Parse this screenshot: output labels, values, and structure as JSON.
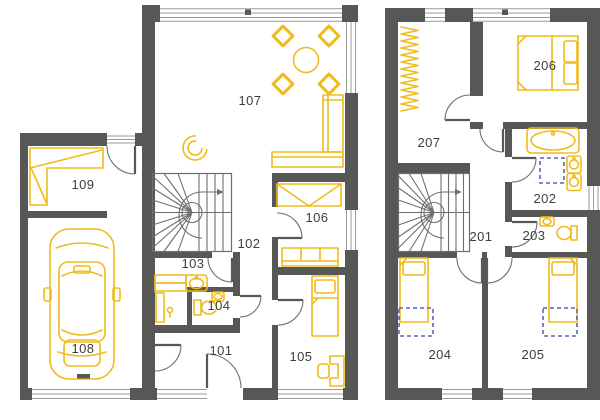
{
  "plan": {
    "type": "architectural-floor-plan",
    "floors": [
      {
        "id": "ground-floor",
        "rooms": [
          {
            "label": "101",
            "features": []
          },
          {
            "label": "102",
            "features": [
              "staircase"
            ]
          },
          {
            "label": "103",
            "features": [
              "washbasin",
              "counter",
              "tap"
            ]
          },
          {
            "label": "104",
            "features": [
              "toilet",
              "washbasin"
            ]
          },
          {
            "label": "105",
            "features": [
              "single-bed",
              "desk",
              "chair"
            ]
          },
          {
            "label": "106",
            "features": [
              "wardrobe",
              "sofa"
            ]
          },
          {
            "label": "107",
            "features": [
              "dining-table",
              "four-chairs",
              "armchair",
              "corner-sofa"
            ]
          },
          {
            "label": "108",
            "features": [
              "car",
              "garage-door"
            ]
          },
          {
            "label": "109",
            "features": [
              "corner-desk"
            ]
          }
        ]
      },
      {
        "id": "upper-floor",
        "rooms": [
          {
            "label": "201",
            "features": [
              "staircase"
            ]
          },
          {
            "label": "202",
            "features": [
              "bathtub",
              "shower-planned",
              "double-washbasin"
            ]
          },
          {
            "label": "203",
            "features": [
              "toilet",
              "washbasin"
            ]
          },
          {
            "label": "204",
            "features": [
              "single-bed",
              "planned-area"
            ]
          },
          {
            "label": "205",
            "features": [
              "single-bed",
              "planned-area"
            ]
          },
          {
            "label": "206",
            "features": [
              "double-bed"
            ]
          },
          {
            "label": "207",
            "features": [
              "open-wardrobe"
            ]
          }
        ]
      }
    ]
  },
  "colors": {
    "wall": "#575756",
    "furniture": "#efbb1c",
    "planned_outline": "#5c64b0",
    "door_line": "#6f6f6f",
    "window_line": "#9a9a9a",
    "label": "#3d3d3d",
    "background": "#ffffff"
  }
}
